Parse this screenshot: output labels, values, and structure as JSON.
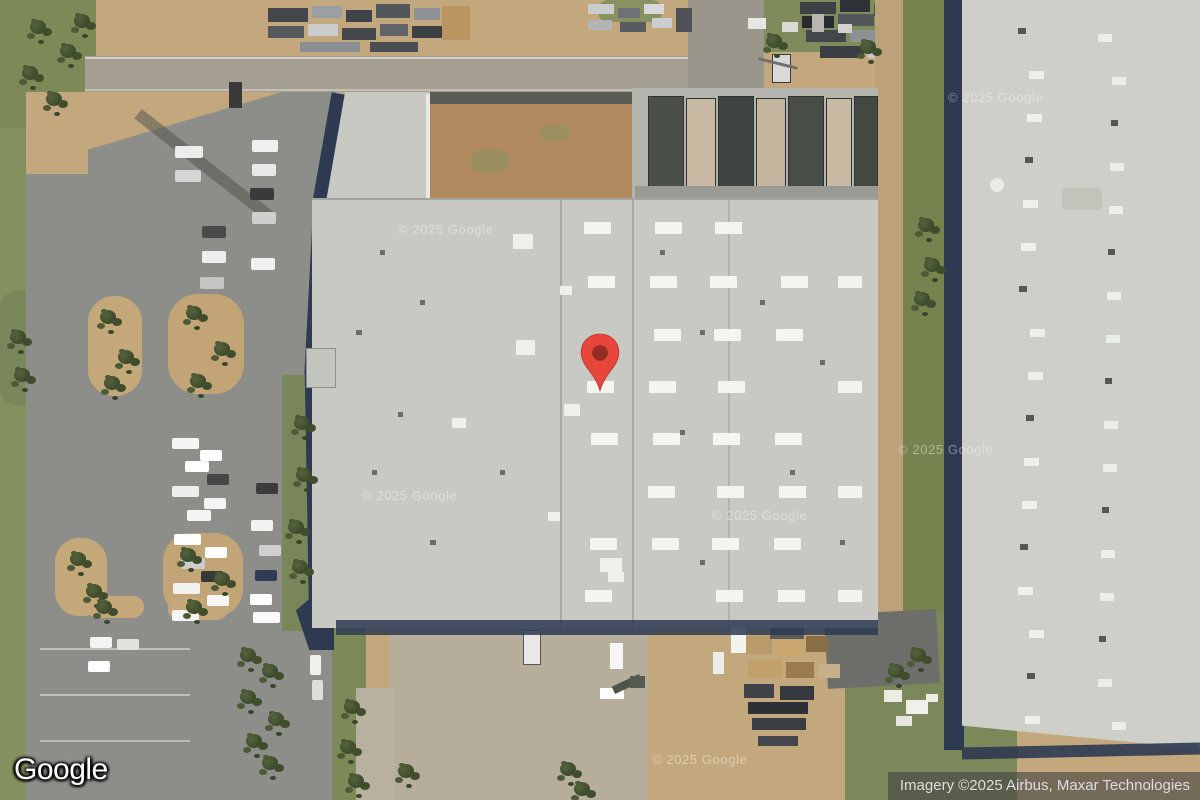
{
  "branding": {
    "logo_text": "Google"
  },
  "attribution": {
    "text": "Imagery ©2025 Airbus, Maxar Technologies"
  },
  "watermark": {
    "text": "© 2025 Google",
    "count": 6
  },
  "marker": {
    "name": "map-pin",
    "color": "#E8453C",
    "stroke": "#BB3A30",
    "dot_color": "#962D24"
  },
  "scene": {
    "description": "Satellite view of industrial warehouse complex with parking lot, construction staging and neighboring building",
    "colors": {
      "dirt": "#c3a87d",
      "grass": "#7d8a58",
      "trees": "#3f4d2c",
      "asphalt": "#8d8d89",
      "road": "#a59f92",
      "apron": "#b6ad9b",
      "main_roof": "#c7c9c2",
      "right_roof": "#cdcfc8",
      "shadow_navy": "#2d3a52"
    }
  }
}
